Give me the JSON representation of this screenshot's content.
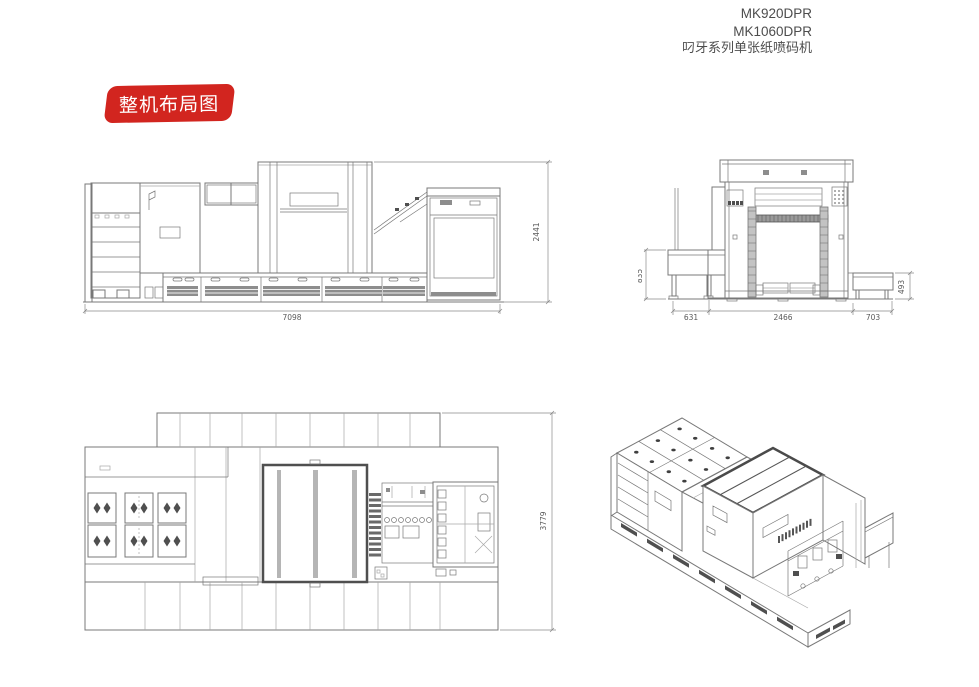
{
  "header": {
    "models": [
      "MK920DPR",
      "MK1060DPR"
    ],
    "series": "叼牙系列单张纸喷码机"
  },
  "badge": {
    "label": "整机布局图",
    "bg_color": "#d2251f",
    "text_color": "#ffffff"
  },
  "colors": {
    "line": "#787878",
    "dim_text": "#5a5a5a",
    "header_text": "#4d4d4d"
  },
  "drawings": {
    "side_view": {
      "dim_width_mm": "7098",
      "dim_height_mm": "2441"
    },
    "front_view": {
      "dim_left_height_mm": "835",
      "dim_bottom_left_mm": "631",
      "dim_bottom_center_mm": "2466",
      "dim_bottom_right_mm": "703",
      "dim_right_height_mm": "493"
    },
    "top_view": {
      "dim_depth_mm": "3779"
    }
  }
}
